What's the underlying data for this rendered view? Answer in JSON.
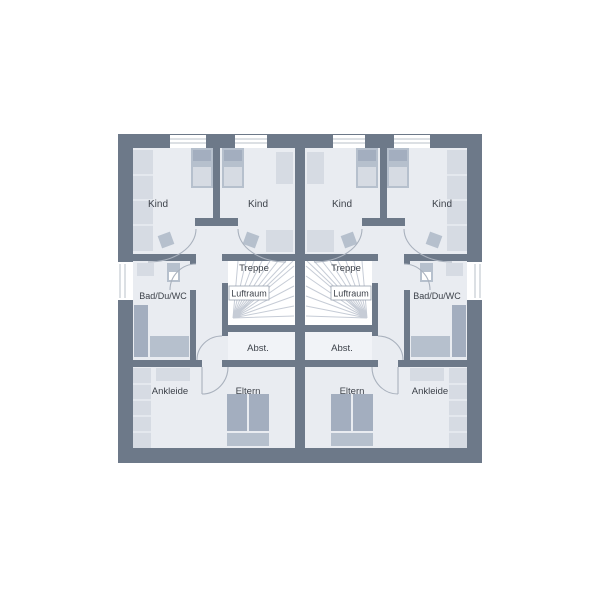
{
  "palette": {
    "wall": "#6d7989",
    "room": "#e9ecf1",
    "room_light": "#f1f3f7",
    "white": "#ffffff",
    "furniture_light": "#d6dbe3",
    "furniture_mid": "#b6c0cd",
    "furniture_dark": "#a3aebf",
    "line": "#a9b1bd",
    "stair_line": "#c6ccd6",
    "text": "#3d424a",
    "window_frame": "#b9c0ca"
  },
  "labels": {
    "kind": "Kind",
    "treppe": "Treppe",
    "luftraum": "Luftraum",
    "abstellraum": "Abst.",
    "bad": "Bad/Du/WC",
    "ankleide": "Ankleide",
    "eltern": "Eltern"
  },
  "floor_plan": {
    "type": "duplex-upper-floor-plan",
    "units": [
      {
        "side": "left",
        "rooms": [
          "Kind",
          "Kind",
          "Bad/Du/WC",
          "Treppe",
          "Luftraum",
          "Abst.",
          "Ankleide",
          "Eltern"
        ]
      },
      {
        "side": "right",
        "rooms": [
          "Kind",
          "Kind",
          "Bad/Du/WC",
          "Treppe",
          "Luftraum",
          "Abst.",
          "Ankleide",
          "Eltern"
        ]
      }
    ]
  }
}
